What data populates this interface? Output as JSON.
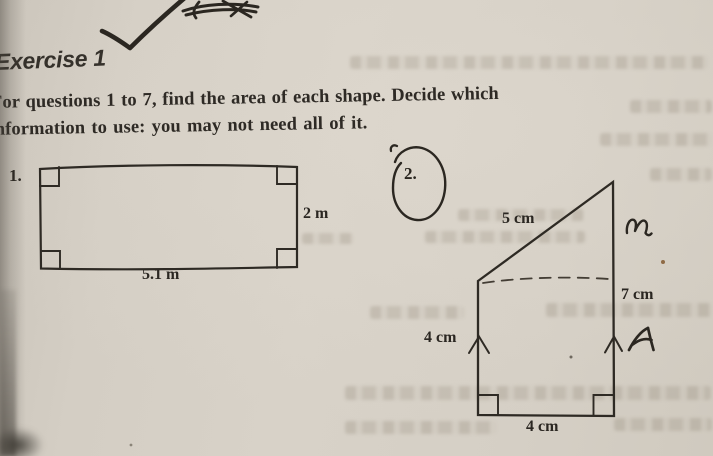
{
  "colors": {
    "paper": "#d6d0c6",
    "print_ink": "#2e2a25",
    "pen_ink": "#2b2721"
  },
  "header": {
    "title": "Exercise 1"
  },
  "instructions": {
    "line1": "For questions 1 to 7, find the area of each shape. Decide which",
    "line2": "information to use: you may not need all of it."
  },
  "questions": [
    {
      "number": "1.",
      "shape": "rectangle",
      "side_label": "2 m",
      "base_label": "5.1 m"
    },
    {
      "number": "2.",
      "shape": "right trapezoid with slanted top",
      "slant_label": "5 cm",
      "right_label": "7 cm",
      "left_label": "4 cm",
      "base_label": "4 cm"
    }
  ]
}
